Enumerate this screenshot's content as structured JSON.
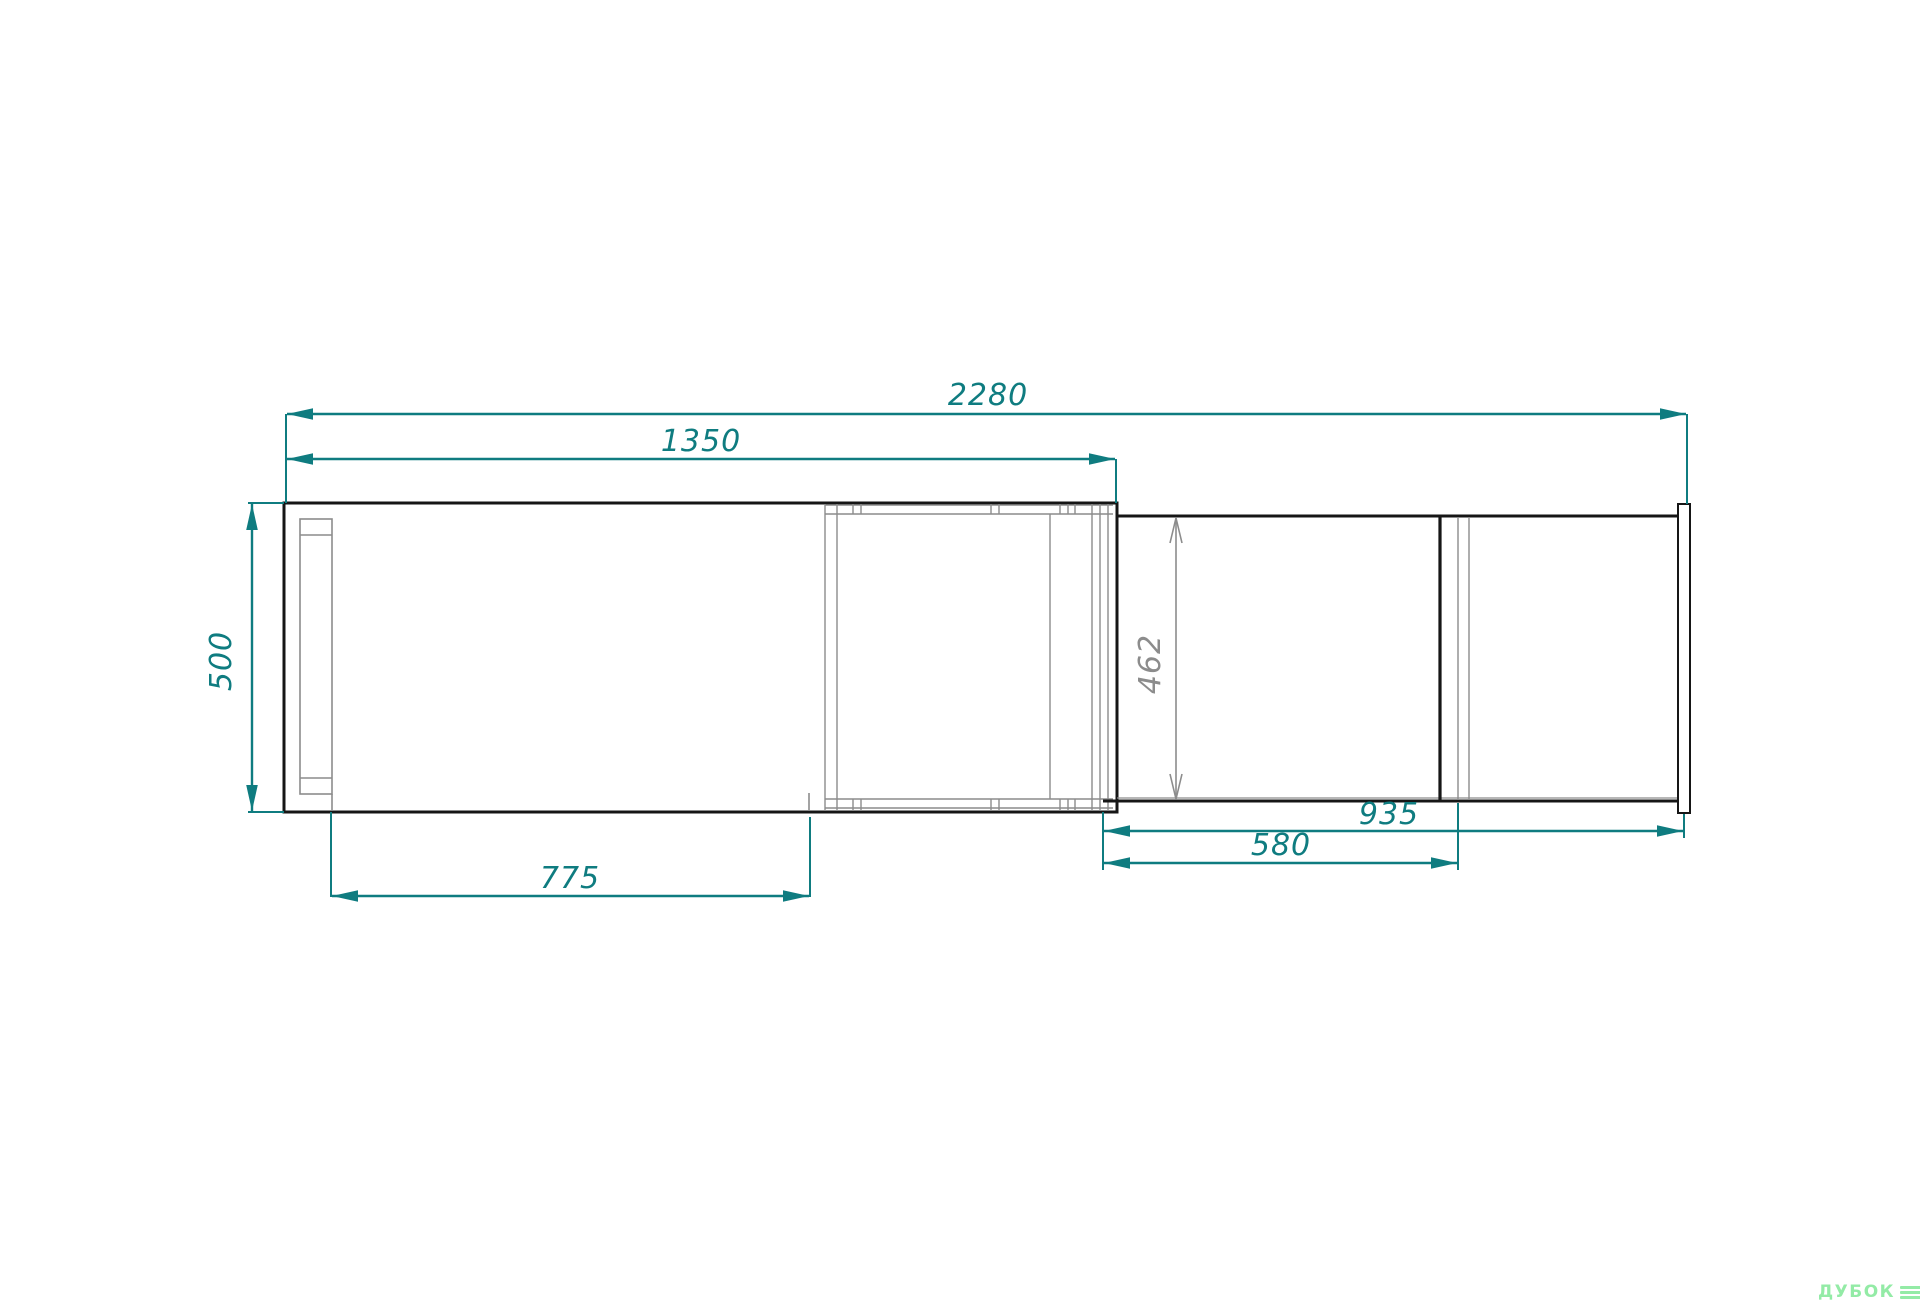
{
  "drawing": {
    "type": "furniture-top-view-technical-drawing",
    "colors": {
      "dimension_teal": "#0f7c80",
      "outline_black": "#161616",
      "thin_gray": "#8c8c8c",
      "logo_green": "#93eba6",
      "background": "#ffffff"
    },
    "dimensions": {
      "overall_width": {
        "value": "2280",
        "orientation": "horizontal"
      },
      "body_width": {
        "value": "1350",
        "orientation": "horizontal"
      },
      "body_depth": {
        "value": "500",
        "orientation": "vertical"
      },
      "left_span": {
        "value": "775",
        "orientation": "horizontal"
      },
      "extension_depth": {
        "value": "462",
        "orientation": "vertical"
      },
      "extension_span": {
        "value": "935",
        "orientation": "horizontal"
      },
      "extension_inner_span": {
        "value": "580",
        "orientation": "horizontal"
      }
    },
    "logo": {
      "text": "ДУБОК"
    }
  }
}
